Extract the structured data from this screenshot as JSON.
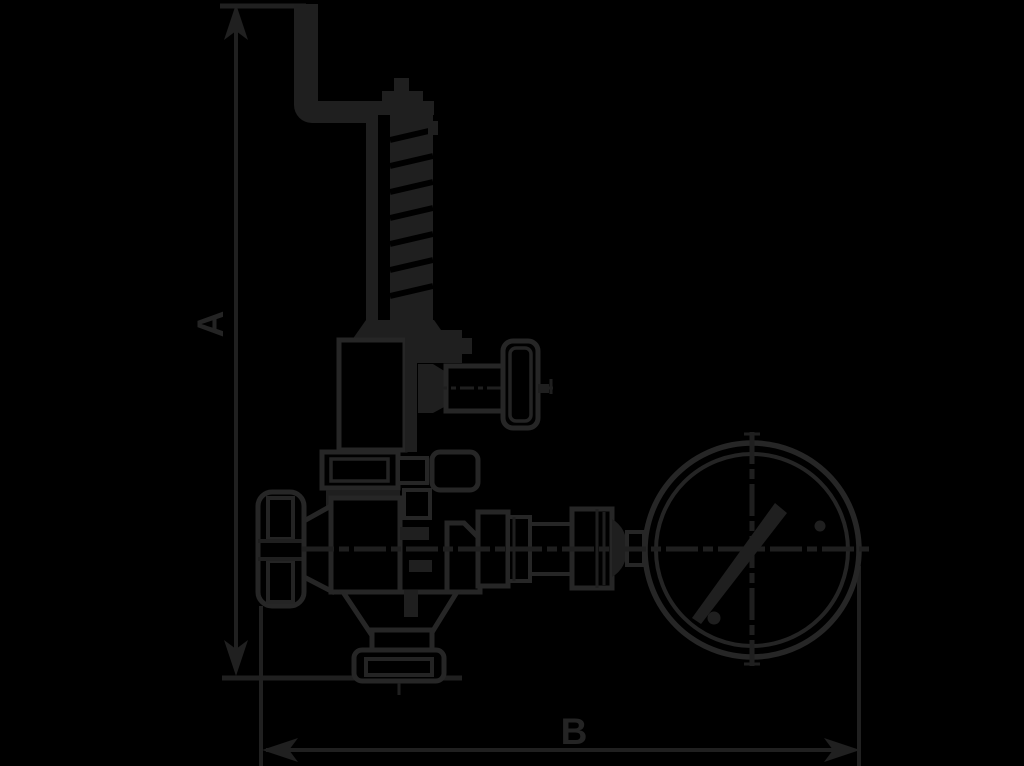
{
  "drawing": {
    "type": "technical-dimensional-drawing",
    "subject": "safety valve with lift lever, handwheels and pressure gauge",
    "background_color": "#000000",
    "ink_color": "#1f1f1f",
    "labels": {
      "dim_a": "A",
      "dim_b": "B"
    },
    "parts": {
      "lever": "lift-lever",
      "spring_bonnet": "spring-bonnet",
      "side_outlet": "side-outlet-handwheel",
      "inlet_handwheel": "inlet-handwheel",
      "valve_body": "valve-body",
      "bottom_flange": "bottom-outlet-flange",
      "gauge_fitting": "gauge-connection-fitting",
      "pressure_gauge": "pressure-gauge"
    }
  }
}
